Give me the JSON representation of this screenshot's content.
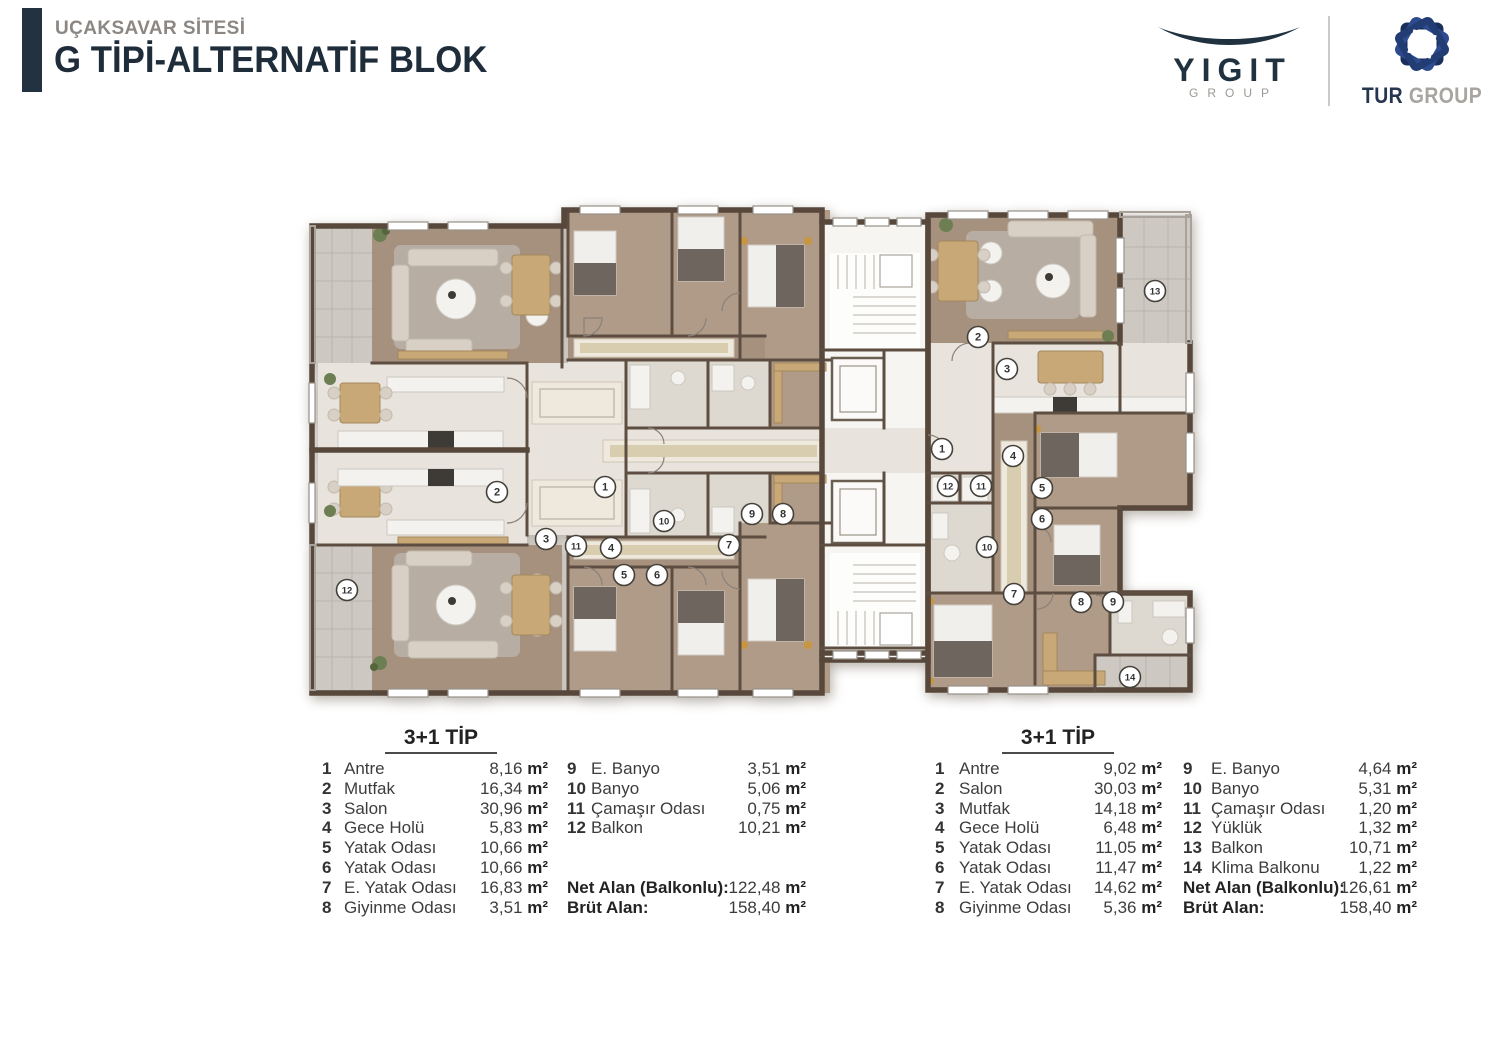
{
  "header": {
    "project": "UÇAKSAVAR SİTESİ",
    "block": "G TİPİ-ALTERNATİF BLOK"
  },
  "logos": {
    "yigit_name": "YIGIT",
    "yigit_sub": "GROUP",
    "tur_name": "TUR",
    "tur_sub": "GROUP"
  },
  "colors": {
    "title_navy": "#1f2d3b",
    "subtitle_gray": "#8c8783",
    "tur_blue": "#2d4b8e",
    "tur_navy": "#1b2f5c",
    "wall_brown": "#57483b",
    "wood_floor": "#a6917e",
    "tile_floor": "#e8e4dd",
    "balcony_gray": "#cdc8c1"
  },
  "area_unit": "m²",
  "tables": [
    {
      "title": "3+1 TİP",
      "rooms": [
        {
          "no": "1",
          "name": "Antre",
          "area": "8,16"
        },
        {
          "no": "2",
          "name": "Mutfak",
          "area": "16,34"
        },
        {
          "no": "3",
          "name": "Salon",
          "area": "30,96"
        },
        {
          "no": "4",
          "name": "Gece Holü",
          "area": "5,83"
        },
        {
          "no": "5",
          "name": "Yatak Odası",
          "area": "10,66"
        },
        {
          "no": "6",
          "name": "Yatak Odası",
          "area": "10,66"
        },
        {
          "no": "7",
          "name": "E. Yatak Odası",
          "area": "16,83"
        },
        {
          "no": "8",
          "name": "Giyinme Odası",
          "area": "3,51"
        },
        {
          "no": "9",
          "name": "E. Banyo",
          "area": "3,51"
        },
        {
          "no": "10",
          "name": "Banyo",
          "area": "5,06"
        },
        {
          "no": "11",
          "name": "Çamaşır Odası",
          "area": "0,75"
        },
        {
          "no": "12",
          "name": "Balkon",
          "area": "10,21"
        }
      ],
      "totals": [
        {
          "label": "Net  Alan (Balkonlu):",
          "area": "122,48"
        },
        {
          "label": "Brüt Alan:",
          "area": "158,40"
        }
      ]
    },
    {
      "title": "3+1 TİP",
      "rooms": [
        {
          "no": "1",
          "name": "Antre",
          "area": "9,02"
        },
        {
          "no": "2",
          "name": "Salon",
          "area": "30,03"
        },
        {
          "no": "3",
          "name": "Mutfak",
          "area": "14,18"
        },
        {
          "no": "4",
          "name": "Gece Holü",
          "area": "6,48"
        },
        {
          "no": "5",
          "name": "Yatak Odası",
          "area": "11,05"
        },
        {
          "no": "6",
          "name": "Yatak Odası",
          "area": "11,47"
        },
        {
          "no": "7",
          "name": "E. Yatak Odası",
          "area": "14,62"
        },
        {
          "no": "8",
          "name": "Giyinme Odası",
          "area": "5,36"
        },
        {
          "no": "9",
          "name": "E. Banyo",
          "area": "4,64"
        },
        {
          "no": "10",
          "name": "Banyo",
          "area": "5,31"
        },
        {
          "no": "11",
          "name": "Çamaşır Odası",
          "area": "1,20"
        },
        {
          "no": "12",
          "name": "Yüklük",
          "area": "1,32"
        },
        {
          "no": "13",
          "name": "Balkon",
          "area": "10,71"
        },
        {
          "no": "14",
          "name": "Klima Balkonu",
          "area": "1,22"
        }
      ],
      "totals": [
        {
          "label": "Net  Alan (Balkonlu):",
          "area": "126,61"
        },
        {
          "label": "Brüt Alan:",
          "area": "158,40"
        }
      ]
    }
  ],
  "plan": {
    "markers_left_unit": [
      {
        "n": "1",
        "x": 297,
        "y": 294
      },
      {
        "n": "2",
        "x": 189,
        "y": 299
      },
      {
        "n": "3",
        "x": 238,
        "y": 346
      },
      {
        "n": "4",
        "x": 303,
        "y": 355
      },
      {
        "n": "5",
        "x": 316,
        "y": 382
      },
      {
        "n": "6",
        "x": 349,
        "y": 382
      },
      {
        "n": "7",
        "x": 421,
        "y": 352
      },
      {
        "n": "8",
        "x": 475,
        "y": 321
      },
      {
        "n": "9",
        "x": 444,
        "y": 321
      },
      {
        "n": "10",
        "x": 356,
        "y": 328
      },
      {
        "n": "11",
        "x": 268,
        "y": 353
      },
      {
        "n": "12",
        "x": 39,
        "y": 397
      }
    ],
    "markers_right_unit": [
      {
        "n": "1",
        "x": 634,
        "y": 256
      },
      {
        "n": "2",
        "x": 670,
        "y": 144
      },
      {
        "n": "3",
        "x": 699,
        "y": 176
      },
      {
        "n": "4",
        "x": 705,
        "y": 263
      },
      {
        "n": "5",
        "x": 734,
        "y": 295
      },
      {
        "n": "6",
        "x": 734,
        "y": 326
      },
      {
        "n": "7",
        "x": 706,
        "y": 401
      },
      {
        "n": "8",
        "x": 773,
        "y": 409
      },
      {
        "n": "9",
        "x": 805,
        "y": 409
      },
      {
        "n": "10",
        "x": 679,
        "y": 354
      },
      {
        "n": "11",
        "x": 673,
        "y": 293
      },
      {
        "n": "12",
        "x": 640,
        "y": 293
      },
      {
        "n": "13",
        "x": 847,
        "y": 98
      },
      {
        "n": "14",
        "x": 822,
        "y": 484
      }
    ]
  }
}
